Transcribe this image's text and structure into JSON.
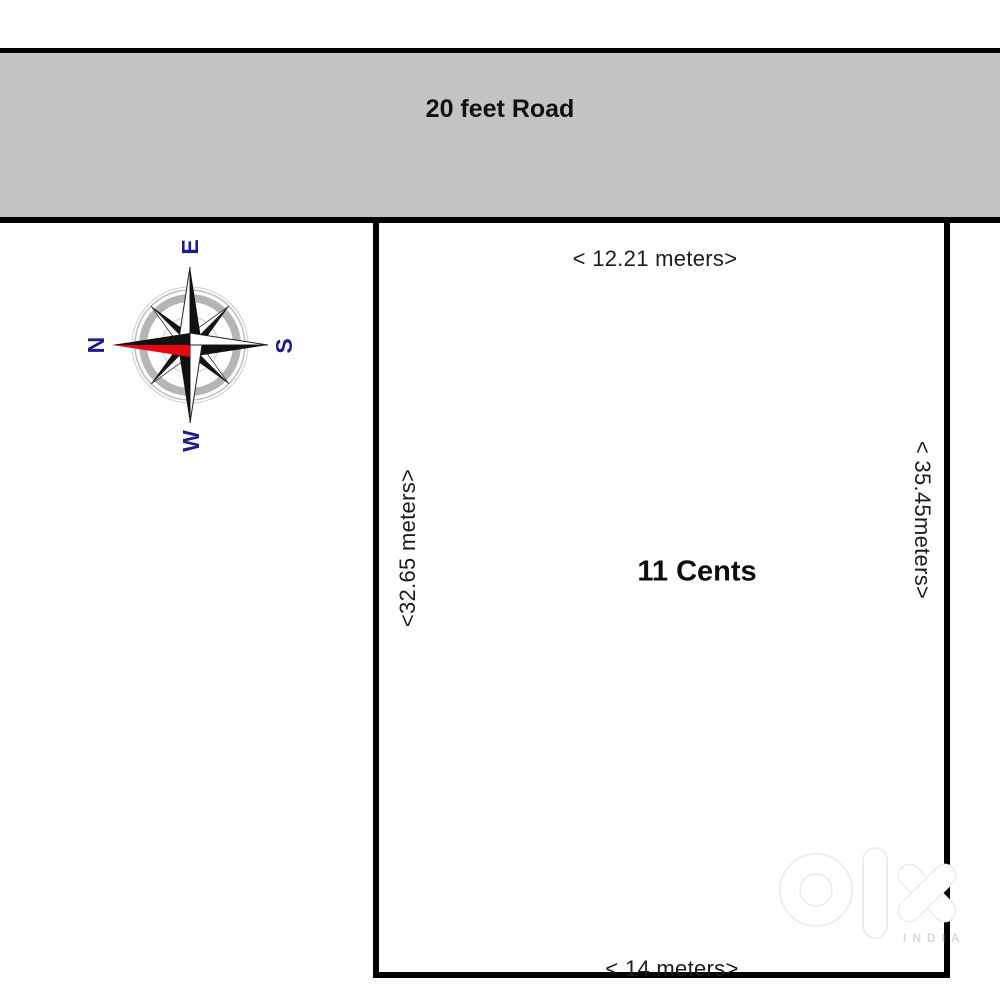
{
  "road": {
    "label": "20 feet Road"
  },
  "plot": {
    "area_label": "11 Cents",
    "dimensions": {
      "top": "< 12.21 meters>",
      "bottom": "< 14 meters>",
      "left": "<32.65 meters>",
      "right": "< 35.45meters>"
    }
  },
  "compass": {
    "north": "N",
    "east": "E",
    "south": "S",
    "west": "W"
  },
  "watermark": {
    "brand": "olx",
    "country": "INDIA"
  },
  "colors": {
    "road_fill": "#c3c3c3",
    "border": "#000000",
    "dimension_text": "#1c1c1c",
    "compass_letter": "#1c1c8e",
    "compass_red": "#e30613",
    "compass_ring_gray": "#b5b5b5",
    "watermark_outline": "#ececec"
  }
}
